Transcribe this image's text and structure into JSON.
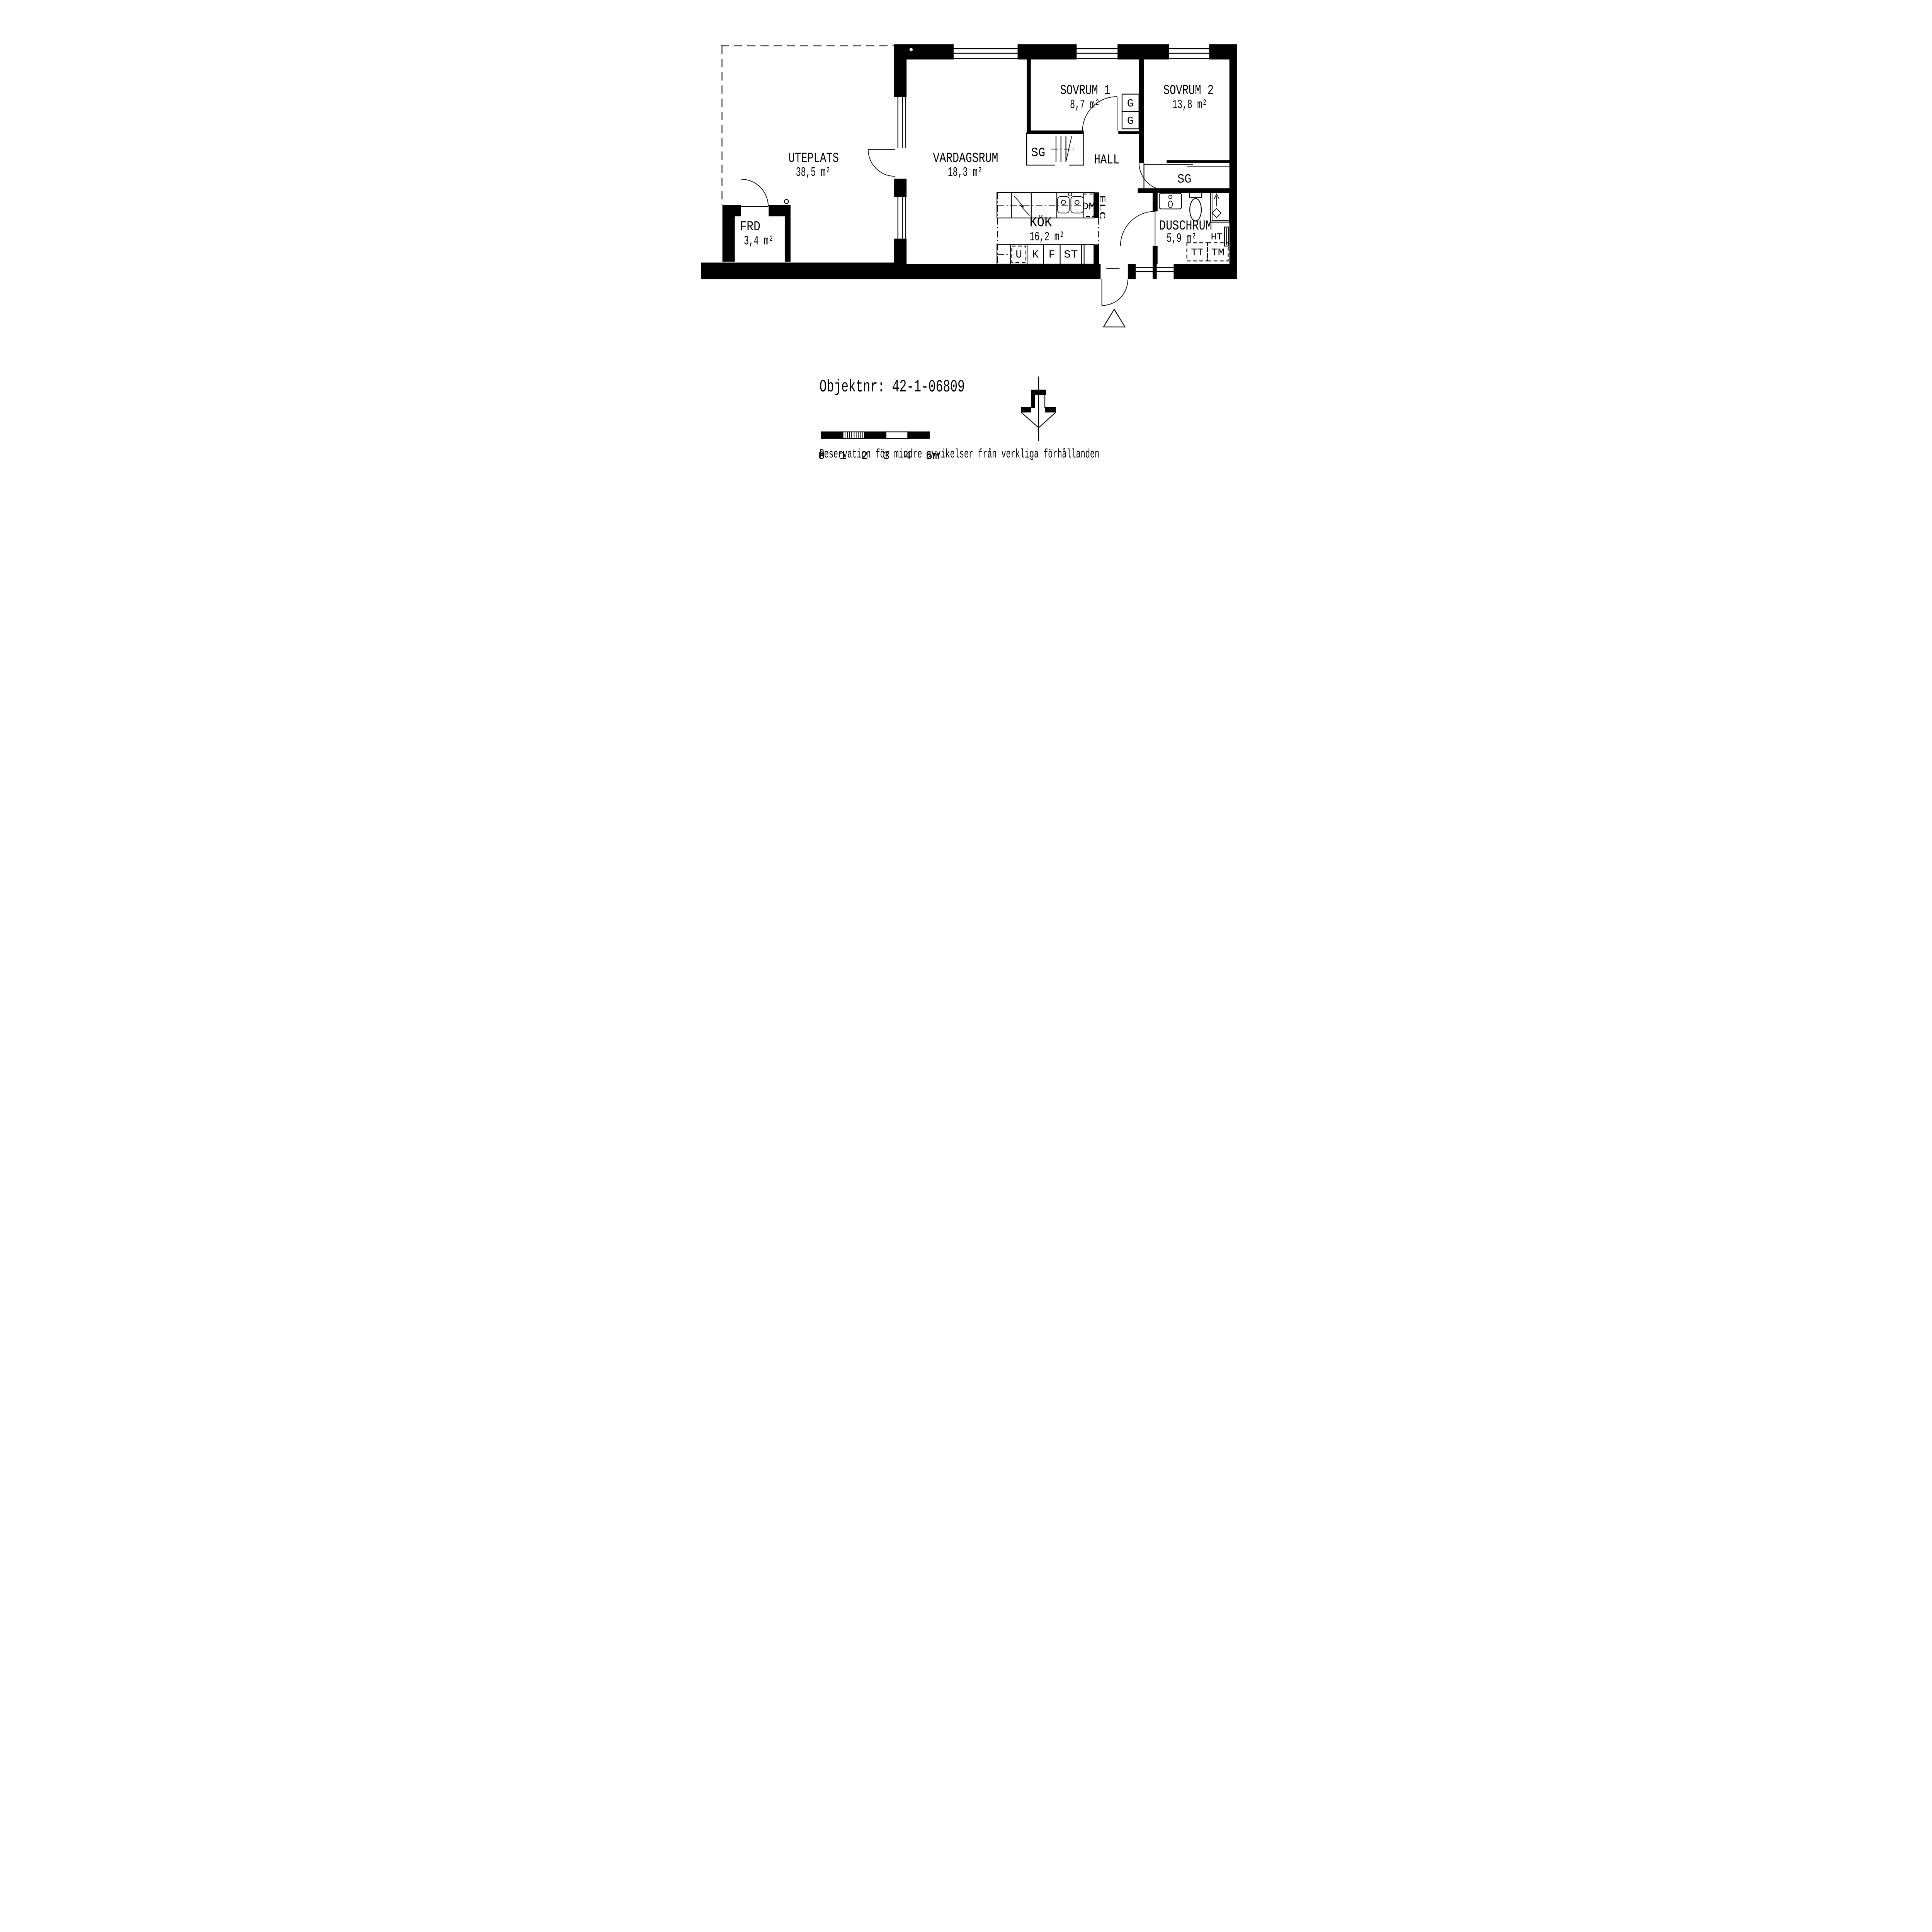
{
  "rooms": {
    "uteplats": {
      "name": "UTEPLATS",
      "area": "38,5 m²"
    },
    "vardagsrum": {
      "name": "VARDAGSRUM",
      "area": "18,3 m²"
    },
    "sovrum1": {
      "name": "SOVRUM 1",
      "area": "8,7 m²"
    },
    "sovrum2": {
      "name": "SOVRUM 2",
      "area": "13,8 m²"
    },
    "hall": {
      "name": "HALL"
    },
    "kok": {
      "name": "KÖK",
      "area": "16,2 m²"
    },
    "duschrum": {
      "name": "DUSCHRUM",
      "area": "5,9 m²"
    },
    "frd": {
      "name": "FRD",
      "area": "3,4 m²"
    }
  },
  "labels": {
    "sg1": "SG",
    "sg2": "SG",
    "g": "G",
    "dm": "DM",
    "elc": "ELC",
    "u": "U",
    "k": "K",
    "f": "F",
    "st": "ST",
    "tt": "TT",
    "tm": "TM",
    "ht": "HT"
  },
  "footer": {
    "object_label": "Objektnr: 42-1-06809",
    "disclaimer": "Reservation för mindre avvikelser från verkliga förhållanden"
  },
  "scale_bar": {
    "ticks": [
      "0",
      "1",
      "2",
      "3",
      "4",
      "5m"
    ]
  },
  "colors": {
    "ink": "#000000",
    "paper": "#ffffff"
  }
}
